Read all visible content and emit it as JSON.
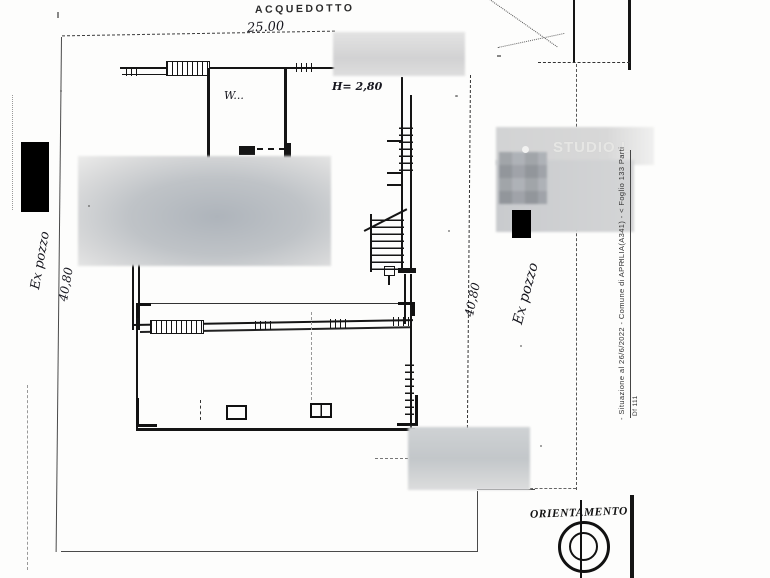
{
  "scan": {
    "annotations": {
      "acquedotto": "ACQUEDOTTO",
      "dim_top": "25.00",
      "room_wc": "W...",
      "height_note": "H= 2,80",
      "dim_left": "40,80",
      "dim_right": "40,80",
      "well_left": "Ex pozzo",
      "well_right": "Ex pozzo"
    },
    "watermark": {
      "text": "STUDIO L"
    },
    "margin_note": {
      "text": "- Situazione al 26/6/2022 - Comune di APRILIA(A341) - < Foglio 133 Parti",
      "tag": "Df 111"
    },
    "compass": {
      "label": "ORIENTAMENTO"
    },
    "colors": {
      "ink": "#151515",
      "boundary": "#4a4a4a",
      "redaction": "#000000",
      "blur_base": "#c9cbce",
      "blur_dark": "#a2a6ac",
      "watermark_gray": "#e6e6e4"
    }
  }
}
